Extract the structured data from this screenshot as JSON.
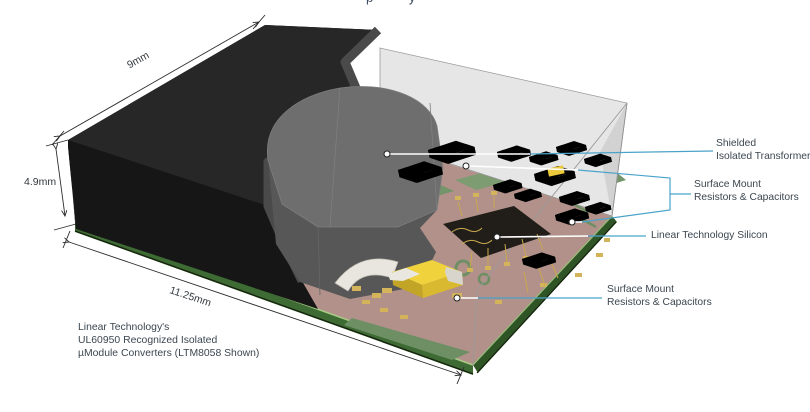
{
  "figure": {
    "cropped_title_fragment": "p y",
    "dimensions": {
      "top_edge": "9mm",
      "height": "4.9mm",
      "front_edge": "11.25mm"
    },
    "callouts": {
      "transformer": {
        "line1": "Shielded",
        "line2": "Isolated Transformer"
      },
      "smt_upper": {
        "line1": "Surface Mount",
        "line2": "Resistors & Capacitors"
      },
      "silicon": {
        "label": "Linear Technology Silicon"
      },
      "smt_lower": {
        "line1": "Surface Mount",
        "line2": "Resistors & Capacitors"
      }
    },
    "caption": {
      "line1": "Linear Technology's",
      "line2": "UL60950 Recognized Isolated",
      "line3": "µModule Converters (LTM8058 Shown)"
    },
    "colors": {
      "callout_line_blue": "#4aa3c9",
      "leader_line_white": "#ffffff",
      "label_text": "#3b4650",
      "dimension_line": "#2b2b2b",
      "mold_black": "#1c1c1c",
      "shield_gray": "#666666",
      "ghost_gray": "#e4e4e4",
      "pcb_tan": "#b2918a",
      "pcb_trace_green": "#74956a",
      "board_edge_green": "#3e6b33",
      "component_yellow": "#ecc93a",
      "gold": "#c9a84c"
    }
  }
}
